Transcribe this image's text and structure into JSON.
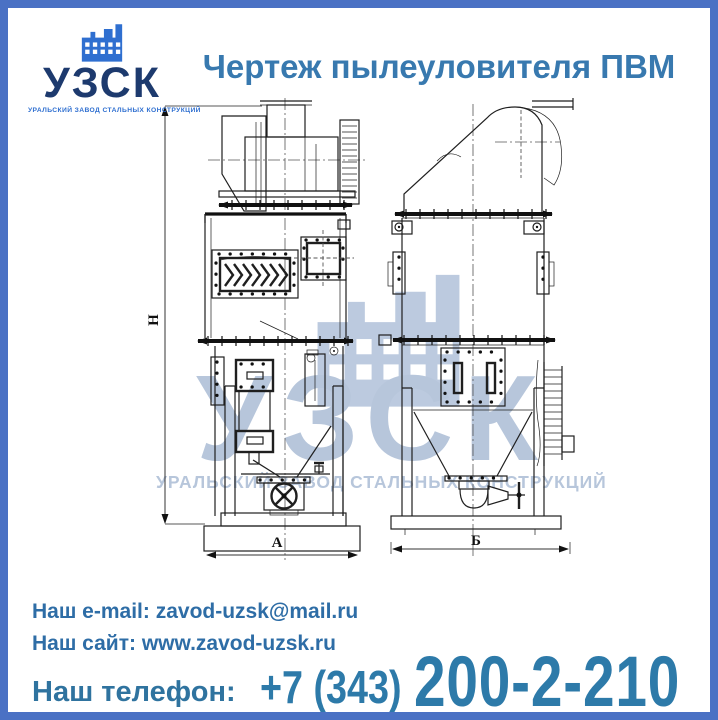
{
  "brand": {
    "abbr": "УЗСК",
    "tagline": "УРАЛЬСКИЙ ЗАВОД СТАЛЬНЫХ КОНСТРУКЦИЙ"
  },
  "header": {
    "title": "Чертеж пылеуловителя ПВМ"
  },
  "drawing": {
    "subject": "пылеуловитель ПВМ",
    "dimensions": {
      "height": "H",
      "front_width": "А",
      "side_width": "Б"
    }
  },
  "watermark": {
    "abbr": "УЗСК",
    "tagline": "УРАЛЬСКИЙ ЗАВОД СТАЛЬНЫХ КОНСТРУКЦИЙ"
  },
  "contacts": {
    "email_label": "Наш e-mail:",
    "email": "zavod-uzsk@mail.ru",
    "site_label": "Наш сайт:",
    "site": "www.zavod-uzsk.ru",
    "phone_label": "Наш телефон:",
    "phone_code": "+7 (343)",
    "phone_number": "200-2-210"
  },
  "colors": {
    "frame": "#4a71c4",
    "title": "#3879af",
    "brand_navy": "#1d3a6e",
    "brand_blue": "#2f6fd0",
    "contact_text": "#2e6da6",
    "phone": "#2d7aa9",
    "watermark": "#b7c6db",
    "drawing_line": "#1f1f1f"
  }
}
